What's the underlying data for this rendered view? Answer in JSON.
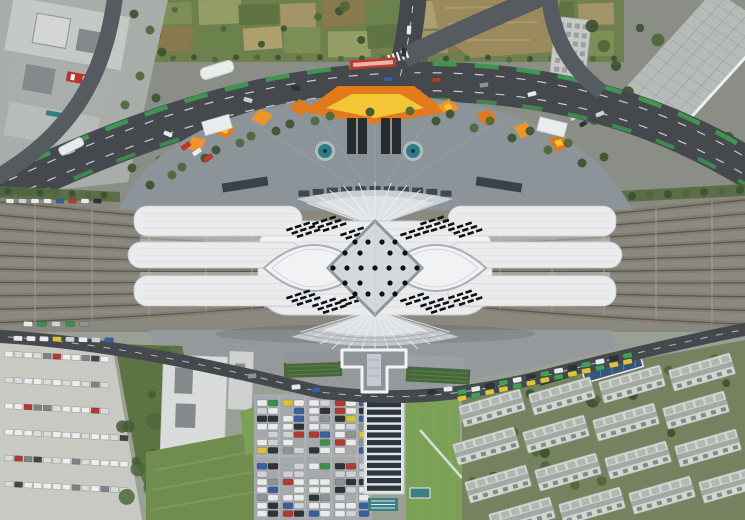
{
  "meta": {
    "type": "aerial-photograph",
    "subject": "Top-down aerial view of a large symmetric high-speed railway station with a diamond-shaped central skylight roof, fan-shaped platform canopies, railway track fans on both sides, a curved boulevard and plaza to the north, and parking lots, lawns, a bus depot and residential blocks to the south"
  },
  "palette": {
    "base": "#8a8e86",
    "farmBase": "#6f7f4d",
    "treeDark": "#3b5230",
    "treeMid": "#4e6739",
    "roadDark": "#45494d",
    "roadMid": "#565b5f",
    "laneWhite": "#e8eaea",
    "bikeGreen": "#3f9e52",
    "plazaGray": "#8c9399",
    "plazaLine": "#a2a8ad",
    "canopyOrange": "#e07a1d",
    "canopyOrange2": "#ef9426",
    "canopyYellow": "#f3c636",
    "poolTeal": "#2e7d86",
    "poolRim": "#b3babb",
    "kioskDark": "#262b30",
    "facadeDark": "#3a4147",
    "stationWhite": "#e9ebec",
    "stationSeam": "#d5d9dc",
    "stationEdge": "#c2c7cb",
    "lensFill": "#f1f2f4",
    "lensEdge": "#a9afb5",
    "lensInner": "#c6cbd0",
    "fanGray": "#c9ced3",
    "fanGray2": "#c3c8cd",
    "fanLight": "#dde1e4",
    "fanLine": "#eef0f2",
    "fanArc": "#aab0b5",
    "diamondFill": "#d6d9dc",
    "diamondEdge": "#8f969c",
    "diamondSeam": "#c9cdd1",
    "slitBlack": "#0e1114",
    "trackBase": "#8a887f",
    "trackBed": "#7d796e",
    "trackRail": "#5a564c",
    "trackLight": "#a29c8e",
    "mast": "#9aa0a2",
    "vergeGreen": "#52683e",
    "southGround": "#9aa096",
    "southPlaza": "#95999c",
    "greenRoof": "#47683b",
    "greenRoofLine": "#5d8048",
    "tFrame": "#f3f4f5",
    "tFill": "#8f9499",
    "tSky": "#c3cbd1",
    "wingGray": "#9aa0a4",
    "depotPale": "#c9c9c3",
    "scrub": "#5e7343",
    "scrubDark": "#475a31",
    "bldgWhite": "#dadcdb",
    "bldgWhite2": "#ced1cf",
    "bldgCourt": "#84898b",
    "lawn": "#6f8d4f",
    "lawnBright": "#7ba157",
    "lawnStripe": "#86a463",
    "lawnPath": "#d8dcd6",
    "lotGray": "#a5a9ac",
    "lotLine": "#c6c9cb",
    "solarDark": "#2c3640",
    "solarFrame": "#e2e5e5",
    "shedTeal": "#3b7f83",
    "resiBase": "#76825f",
    "resiRoof": "#d2d5d0",
    "resiEdge": "#989f99",
    "resiUnit": "#b1b6b1",
    "resiDark": "#6e7572",
    "resiCorr": "#9aa19c",
    "blueRoof": "#35577a",
    "darkRoof": "#2e3a33",
    "tlGround": "#a8ada9",
    "tlRoof": "#c4c8c6",
    "tlRoof2": "#a9aeac",
    "tlLow": "#b7bbb9",
    "tower": "#d2d5d3",
    "helipadRed": "#b8342c",
    "trBldg": "#b6bab8",
    "trGrid": "#959b99",
    "trEdge": "#eef0f0",
    "hotel": "#c6c9c7",
    "hotelWin": "#8e9392",
    "busRed": "#c0392b",
    "dirt": "#9b8a5e",
    "dirtStreak": "#b3a375",
    "whiteStruct": "#e9ecec",
    "shadow": "rgba(30,35,40,0.25)"
  },
  "plaza": {
    "canopy_positions": [
      [
        225,
        130,
        -18
      ],
      [
        262,
        117,
        -10
      ],
      [
        300,
        107,
        -5
      ],
      [
        448,
        107,
        5
      ],
      [
        487,
        117,
        10
      ],
      [
        524,
        130,
        16
      ],
      [
        559,
        143,
        22
      ],
      [
        196,
        144,
        -24
      ]
    ],
    "tree_arc_outer": [
      [
        150,
        185
      ],
      [
        182,
        167
      ],
      [
        216,
        150
      ],
      [
        251,
        136
      ],
      [
        290,
        124
      ],
      [
        330,
        116
      ],
      [
        370,
        112
      ],
      [
        410,
        111
      ],
      [
        450,
        114
      ],
      [
        490,
        121
      ],
      [
        530,
        131
      ],
      [
        568,
        143
      ],
      [
        604,
        157
      ]
    ],
    "tree_arc_inner": [
      [
        172,
        175
      ],
      [
        205,
        158
      ],
      [
        240,
        143
      ],
      [
        276,
        131
      ],
      [
        315,
        121
      ],
      [
        436,
        121
      ],
      [
        474,
        128
      ],
      [
        512,
        138
      ],
      [
        548,
        150
      ],
      [
        582,
        163
      ]
    ]
  },
  "station": {
    "dot_rows": [
      [
        242,
        [
          -20,
          -7,
          7,
          20
        ]
      ],
      [
        253,
        [
          -30,
          -15,
          15,
          30
        ]
      ],
      [
        268,
        [
          -42,
          -28,
          -14,
          0,
          14,
          28,
          42
        ]
      ],
      [
        283,
        [
          -30,
          -15,
          15,
          30
        ]
      ],
      [
        294,
        [
          -20,
          -7,
          7,
          20
        ]
      ]
    ],
    "slit_groups": [
      [
        286,
        229,
        3
      ],
      [
        312,
        223,
        3
      ],
      [
        420,
        223,
        3
      ],
      [
        448,
        229,
        3
      ],
      [
        286,
        297,
        3
      ],
      [
        312,
        305,
        3
      ],
      [
        420,
        305,
        3
      ],
      [
        448,
        297,
        3
      ],
      [
        340,
        234,
        2
      ],
      [
        400,
        234,
        2
      ],
      [
        340,
        300,
        2
      ],
      [
        400,
        300,
        2
      ]
    ],
    "fingers_left": [
      [
        134,
        206,
        168,
        30
      ],
      [
        128,
        242,
        174,
        26
      ],
      [
        134,
        276,
        168,
        30
      ]
    ],
    "fingers_right": [
      [
        448,
        206,
        168,
        30
      ],
      [
        448,
        242,
        174,
        26
      ],
      [
        448,
        276,
        168,
        30
      ]
    ],
    "lattice_gaps": [
      [
        140,
        236,
        162,
        6
      ],
      [
        140,
        272,
        162,
        5
      ],
      [
        448,
        236,
        162,
        6
      ],
      [
        448,
        272,
        162,
        5
      ]
    ]
  },
  "railway": {
    "tracks_per_side": 10,
    "mast_xs_left": [
      35,
      92,
      149,
      206,
      252
    ],
    "mast_xs_right": [
      500,
      552,
      604,
      656,
      712
    ]
  },
  "vehicles": {
    "car_colors": [
      "#e9eaea",
      "#cfd2d4",
      "#2e3338",
      "#3a5f9e",
      "#b23a2f",
      "#8e9496",
      "#d8c23b",
      "#3e8f4a"
    ],
    "car_weights": [
      30,
      20,
      20,
      8,
      8,
      8,
      3,
      3
    ],
    "bus_colors": [
      "#eceff0",
      "#d9dcdc",
      "#41464b",
      "#7c8286",
      "#b23a2f"
    ],
    "taxi_cycle": [
      "#3fa357",
      "#ddc63d",
      "#e9eaea",
      "#3fa357",
      "#2e3338",
      "#ddc63d"
    ],
    "boulevard_cars": [
      [
        168,
        134,
        24
      ],
      [
        248,
        100,
        15
      ],
      [
        296,
        88,
        9
      ],
      [
        388,
        79,
        0
      ],
      [
        436,
        80,
        -4
      ],
      [
        484,
        85,
        -9
      ],
      [
        532,
        94,
        -14
      ],
      [
        600,
        114,
        -22
      ]
    ]
  },
  "residential": {
    "rotation_deg": -16,
    "block_centers": [
      [
        492,
        408
      ],
      [
        562,
        396
      ],
      [
        632,
        384
      ],
      [
        702,
        372
      ],
      [
        486,
        446
      ],
      [
        556,
        434
      ],
      [
        626,
        422
      ],
      [
        696,
        410
      ],
      [
        498,
        484
      ],
      [
        568,
        472
      ],
      [
        638,
        460
      ],
      [
        708,
        448
      ],
      [
        522,
        516
      ],
      [
        592,
        506
      ],
      [
        662,
        495
      ],
      [
        732,
        484
      ]
    ]
  },
  "farm": {
    "colors": [
      "#7e8f57",
      "#93a066",
      "#5f7342",
      "#a5966a",
      "#8a7a4e",
      "#69834c",
      "#b0a26e"
    ]
  }
}
